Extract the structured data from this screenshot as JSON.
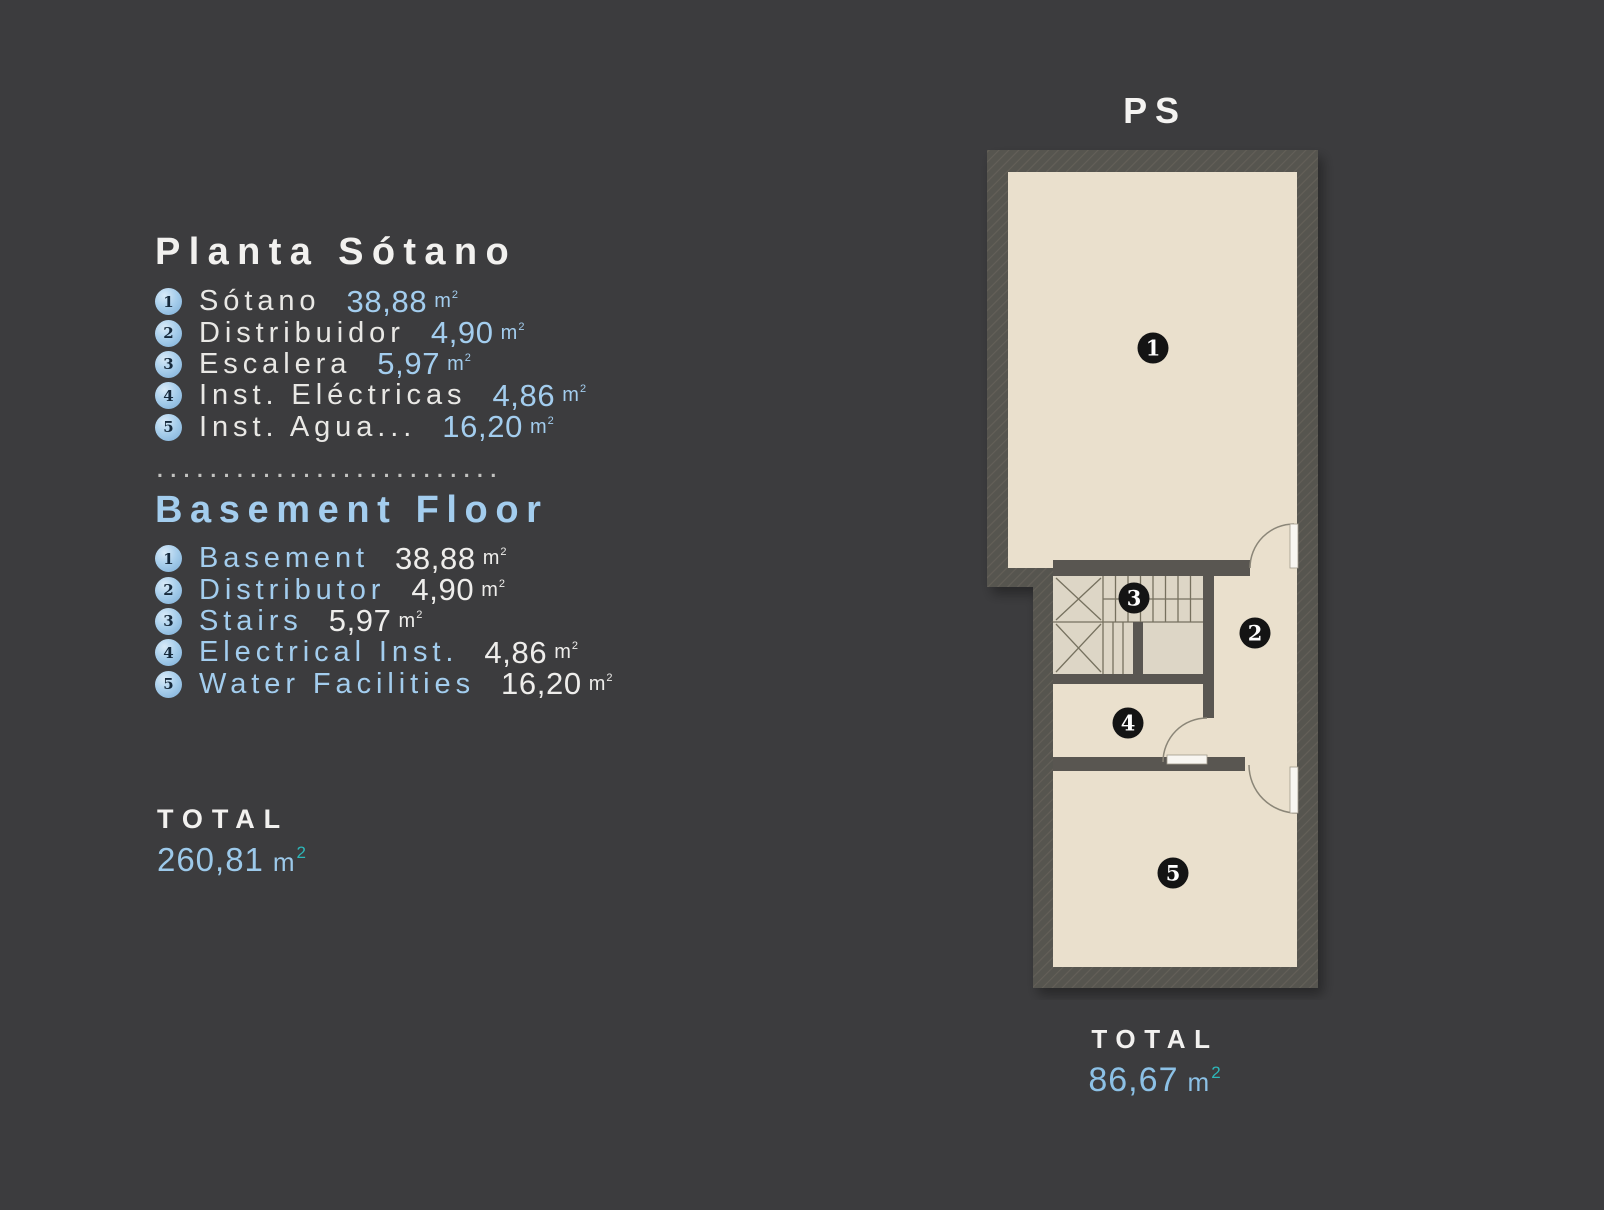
{
  "colors": {
    "background": "#3c3c3e",
    "accent_blue": "#a3cdee",
    "accent_teal": "#2db7b9",
    "text_white": "#f2f1ef",
    "wall_gray": "#57544f",
    "floor_beige": "#eae0cd"
  },
  "legend_es": {
    "title": "Planta Sótano",
    "items": [
      {
        "num": "1",
        "label": "Sótano",
        "value": "38,88",
        "unit": "m",
        "sup": "2"
      },
      {
        "num": "2",
        "label": "Distribuidor",
        "value": "4,90",
        "unit": "m",
        "sup": "2"
      },
      {
        "num": "3",
        "label": "Escalera",
        "value": "5,97",
        "unit": "m",
        "sup": "2"
      },
      {
        "num": "4",
        "label": "Inst. Eléctricas",
        "value": "4,86",
        "unit": "m",
        "sup": "2"
      },
      {
        "num": "5",
        "label": "Inst. Agua...",
        "value": "16,20",
        "unit": "m",
        "sup": "2"
      }
    ]
  },
  "separator_dots": "..........................",
  "legend_en": {
    "title": "Basement Floor",
    "items": [
      {
        "num": "1",
        "label": "Basement",
        "value": "38,88",
        "unit": "m",
        "sup": "2"
      },
      {
        "num": "2",
        "label": "Distributor",
        "value": "4,90",
        "unit": "m",
        "sup": "2"
      },
      {
        "num": "3",
        "label": "Stairs",
        "value": "5,97",
        "unit": "m",
        "sup": "2"
      },
      {
        "num": "4",
        "label": "Electrical Inst.",
        "value": "4,86",
        "unit": "m",
        "sup": "2"
      },
      {
        "num": "5",
        "label": "Water Facilities",
        "value": "16,20",
        "unit": "m",
        "sup": "2"
      }
    ]
  },
  "total_left": {
    "label": "TOTAL",
    "value": "260,81",
    "unit": "m",
    "sup": "2"
  },
  "plan": {
    "title": "PS",
    "room_numbers": [
      "1",
      "2",
      "3",
      "4",
      "5"
    ],
    "total": {
      "label": "TOTAL",
      "value": "86,67",
      "unit": "m",
      "sup": "2"
    }
  }
}
